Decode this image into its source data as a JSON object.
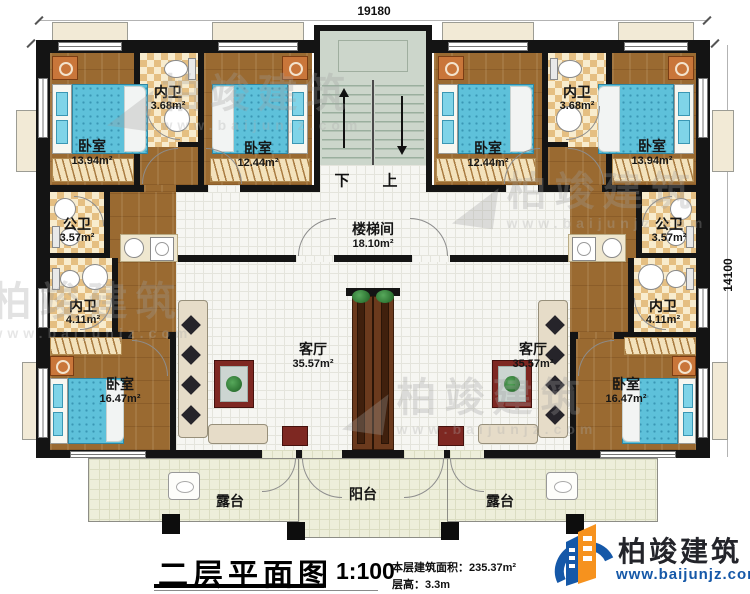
{
  "dimensions": {
    "top": "19180",
    "right": "14100"
  },
  "stairs": {
    "down": "下",
    "up": "上"
  },
  "rooms": {
    "bedroom_tl": {
      "name": "卧室",
      "area": "13.94m²"
    },
    "bath_tl": {
      "name": "内卫",
      "area": "3.68m²"
    },
    "bedroom_tml": {
      "name": "卧室",
      "area": "12.44m²"
    },
    "bedroom_tmr": {
      "name": "卧室",
      "area": "12.44m²"
    },
    "bath_tr": {
      "name": "内卫",
      "area": "3.68m²"
    },
    "bedroom_tr": {
      "name": "卧室",
      "area": "13.94m²"
    },
    "pubbath_l": {
      "name": "公卫",
      "area": "3.57m²"
    },
    "innerbath_l": {
      "name": "内卫",
      "area": "4.11m²"
    },
    "stairwell": {
      "name": "楼梯间",
      "area": "18.10m²"
    },
    "pubbath_r": {
      "name": "公卫",
      "area": "3.57m²"
    },
    "innerbath_r": {
      "name": "内卫",
      "area": "4.11m²"
    },
    "bedroom_bl": {
      "name": "卧室",
      "area": "16.47m²"
    },
    "living_l": {
      "name": "客厅",
      "area": "35.57m²"
    },
    "living_r": {
      "name": "客厅",
      "area": "35.57m²"
    },
    "bedroom_br": {
      "name": "卧室",
      "area": "16.47m²"
    },
    "terrace_l": {
      "name": "露台"
    },
    "balcony": {
      "name": "阳台"
    },
    "terrace_r": {
      "name": "露台"
    }
  },
  "titleblock": {
    "title": "二层平面图",
    "scale": "1:100",
    "area_note": "本层建筑面积：235.37m²",
    "height_note": "层高：3.3m"
  },
  "logo": {
    "name": "柏竣建筑",
    "url": "www.baijunjz.com"
  },
  "watermark": {
    "name": "柏竣建筑",
    "url": "www.baijunjz.com",
    "glyph": "◢"
  },
  "colors": {
    "wall": "#141414",
    "wood_floor": "#9a6a31",
    "bath_checker": "#e5bf82",
    "tile_floor": "#f6f6f2",
    "terrace_floor": "#edeeda",
    "stair_floor": "#ccd6cb",
    "bed_blue": "#5ec1da",
    "logo_blue": "#1558a8",
    "logo_orange": "#f6921e"
  }
}
